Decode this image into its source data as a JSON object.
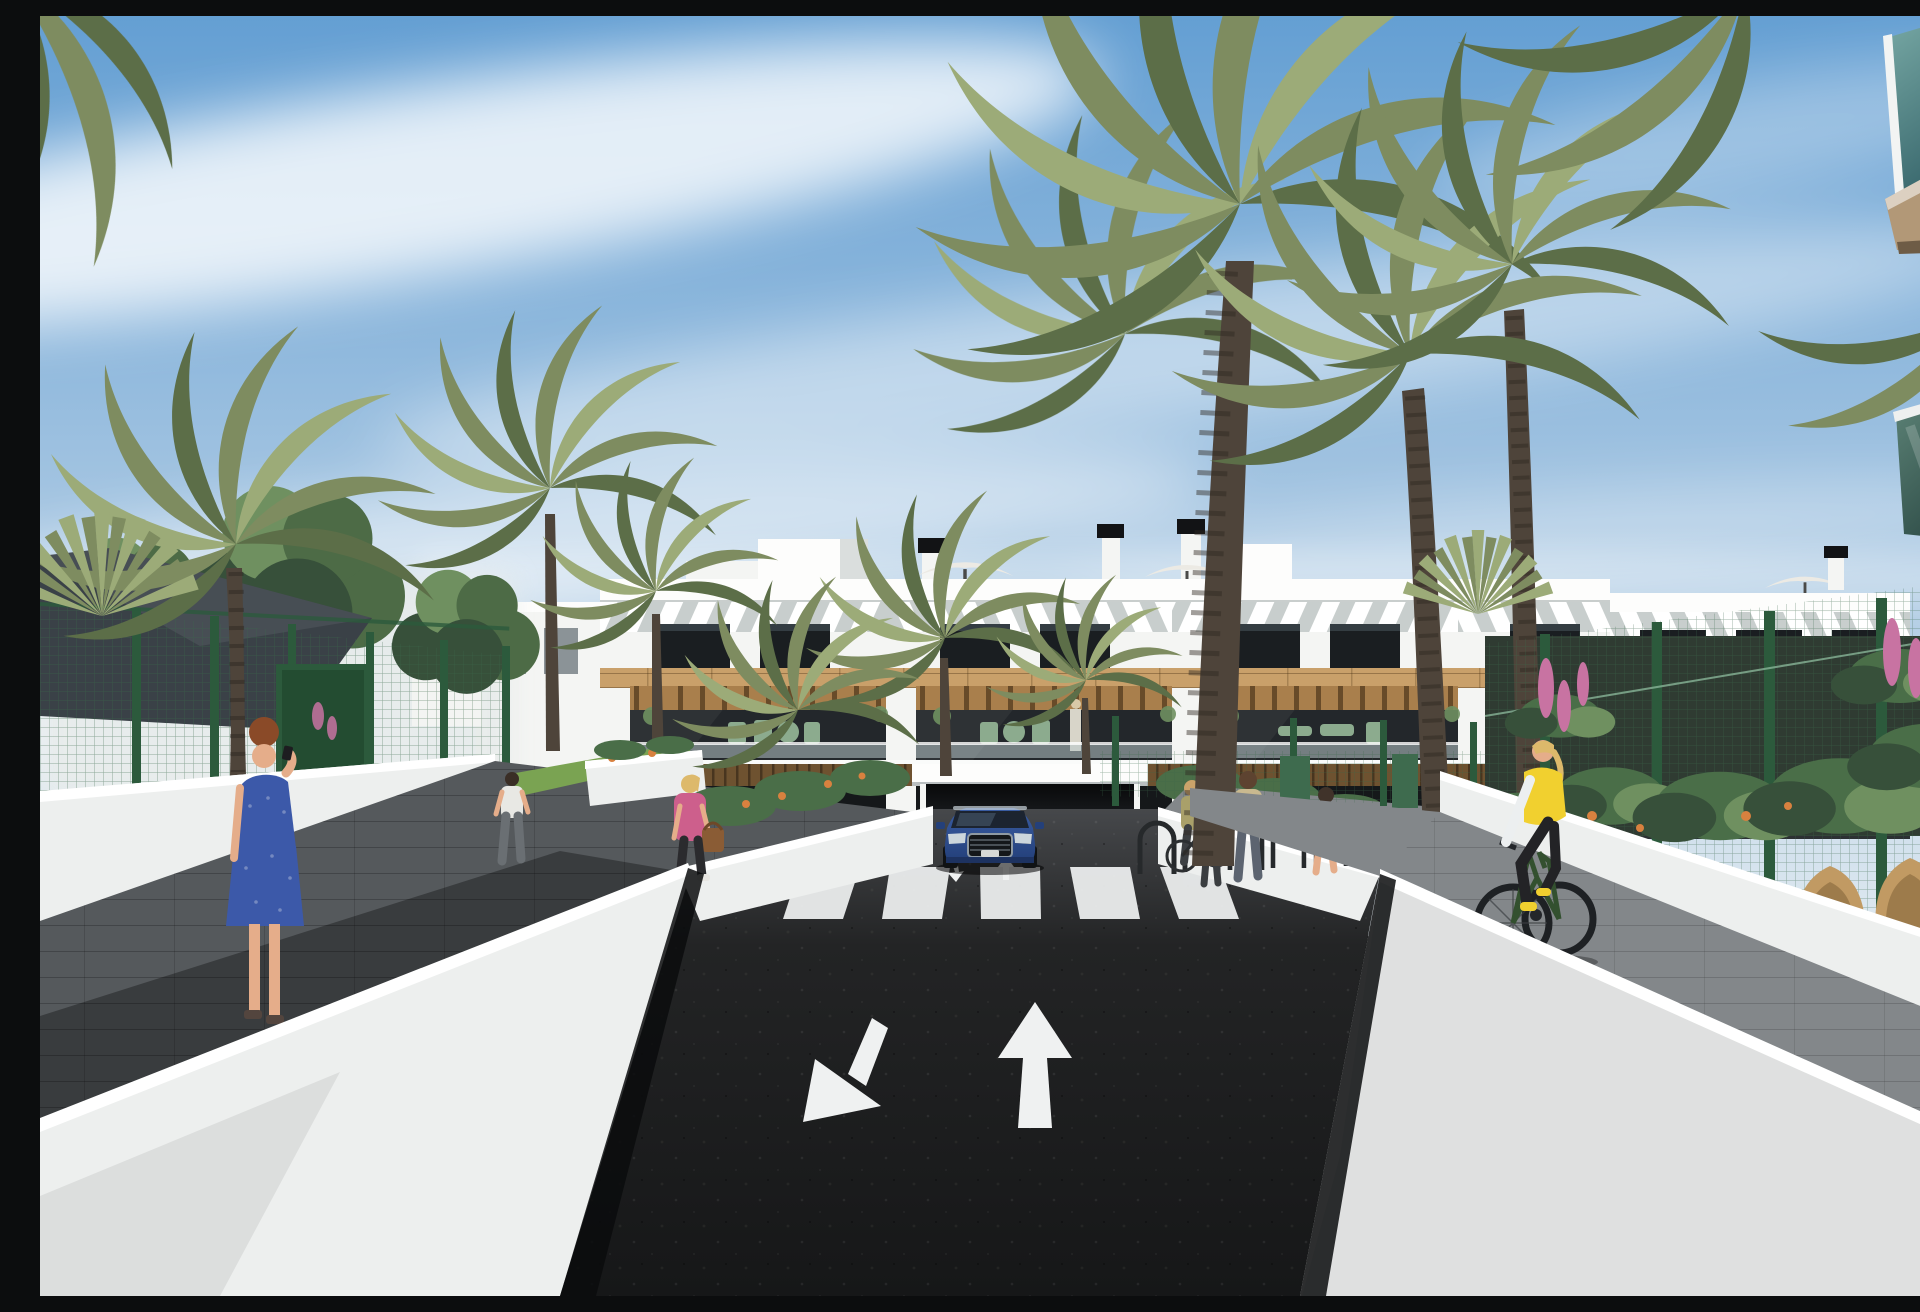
{
  "meta": {
    "title": "Architectural 3D rendering — street entrance of a modern white apartment complex",
    "render_type": "photorealistic exterior visualization",
    "canvas": {
      "width": 1920,
      "height": 1280
    },
    "no_ui_text_visible": true
  },
  "scene": {
    "sky": "clear blue sky with thin diagonal cirrus clouds, hazier toward the left horizon",
    "main_building": {
      "style": "three-storey flat-roof Mediterranean block, white render with wooden cladding band",
      "features": [
        "white diagonal-slat pergola screens on the top floor",
        "dark full-height glazing",
        "timber pergola soffits over first-floor terraces",
        "glass terrace balustrades with sage-green outdoor furniture",
        "roof chimneys with black caps and two white roof parasols",
        "central underground-garage ramp entrance"
      ]
    },
    "foreground_right_building": "close-up corner with teal glass balcony balustrades and tan soffits",
    "road": {
      "surface": "dark fresh asphalt two-way drive",
      "markings": {
        "crosswalk_stripes": 5,
        "large_arrows": [
          {
            "direction": "toward-viewer (down-left)"
          },
          {
            "direction": "away-from-viewer (up)"
          }
        ],
        "small_ramp_arrows": 2
      }
    },
    "vehicle": {
      "type": "SUV",
      "color_name": "blue",
      "position": "exiting garage ramp facing viewer"
    },
    "people": [
      {
        "id": "woman-blue-dress",
        "desc": "red-haired woman in dotted blue dress on left walkway talking on phone"
      },
      {
        "id": "man-white-shirt",
        "desc": "man in white t-shirt walking away on upper left path"
      },
      {
        "id": "woman-pink-jacket",
        "desc": "blonde woman in pink jacket with brown handbag near crosswalk"
      },
      {
        "id": "woman-with-bicycle",
        "desc": "woman wheeling a bicycle by the bike racks"
      },
      {
        "id": "mother-and-child",
        "desc": "woman greeting a small child beside the bike racks"
      },
      {
        "id": "woman-grey-top",
        "desc": "woman in grey top at the bike racks"
      },
      {
        "id": "cyclist-yellow-vest",
        "desc": "blonde cyclist in yellow padded vest riding dark green bike on right path"
      },
      {
        "id": "balcony-couple",
        "desc": "two tiny residents standing on a right-wing terrace"
      }
    ],
    "street_furniture": {
      "bike_racks": 8,
      "rattan_chairs": 2,
      "shade_sail": "dark grey",
      "fences": "green wire-mesh with dark green posts"
    },
    "vegetation": [
      "tall date palms (large cluster right, single left)",
      "small yellow-green palms by the entrance",
      "round leafy trees on the left",
      "low shrubs with orange flowers in planters",
      "pink lupine-like flower spikes in right garden"
    ],
    "walls": "low white rendered walls with bright sunlit caps flanking the drive"
  },
  "palette": {
    "sky_top": "#649fd3",
    "sky_mid": "#a6c6e2",
    "sky_low": "#dfe9f0",
    "cloud": "#ffffff",
    "building_white": "#f4f5f3",
    "building_shade": "#dadedd",
    "parapet_bright": "#fdfdfc",
    "slat_shadow": "#c8cecd",
    "window_dark": "#1a1e21",
    "window_reflect": "#4b575f",
    "wood_light": "#c9a06a",
    "wood_mid": "#a97f4c",
    "wood_dark": "#6e5230",
    "interior_dark": "#23272b",
    "glass_rail": "#b8c6c9",
    "furniture_sage": "#8cab8e",
    "asphalt_far": "#46484b",
    "asphalt_mid": "#232425",
    "asphalt_near": "#161718",
    "marking_white": "#eff1f1",
    "wall_white": "#edefee",
    "wall_shade": "#c7cccc",
    "wall_top": "#ffffff",
    "wall_base_shadow": "#0b0c0d",
    "paver_grey": "#55595c",
    "paver_light": "#83878a",
    "fence_green": "#2c5a3c",
    "mesh_green": "#4c7a58",
    "sail_dark": "#3a4147",
    "palm_green": "#7e8c60",
    "palm_dark": "#5c6e48",
    "palm_light": "#9cab78",
    "trunk_brown": "#4e443a",
    "trunk_ring": "#2e2721",
    "canopy_green": "#4d6b46",
    "canopy_dark": "#37503a",
    "canopy_light": "#6f9060",
    "shrub_green": "#4a6e48",
    "flower_orange": "#d8813f",
    "flower_pink": "#c873a2",
    "glass_teal_top": "#79aaa6",
    "glass_teal_deep": "#3c6b70",
    "glass_green_a": "#5d8377",
    "glass_green_b": "#33524c",
    "soffit_tan": "#b29877",
    "soffit_dark": "#6e5c46",
    "car_blue": "#3a5da4",
    "car_blue_dark": "#24407a",
    "chrome": "#97a2ab",
    "headlight": "#ccd6dc",
    "skin": "#e5ad8a",
    "dress_blue": "#3c59a9",
    "hair_red": "#8a4a28",
    "hair_blonde": "#ddb96b",
    "jacket_pink": "#cd5f8c",
    "vest_yellow": "#f1d02f",
    "bike_green": "#33502f",
    "rattan": "#c19a63"
  }
}
